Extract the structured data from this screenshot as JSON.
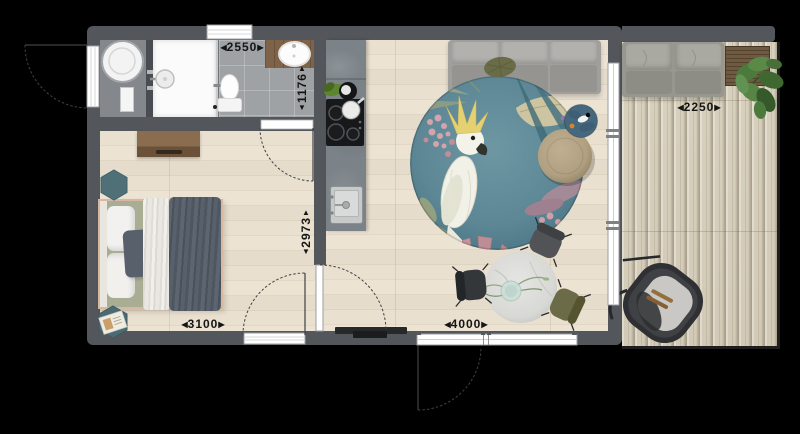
{
  "title": "tiny-house-floor-plan",
  "dimensions": {
    "arrow_left": "◀",
    "arrow_right": "▶",
    "arrow_up": "▲",
    "arrow_down": "▼",
    "bathroom_width": "2550",
    "bathroom_depth": "1176",
    "bedroom_depth": "2973",
    "bedroom_width": "3100",
    "living_width": "4000",
    "terrace_width": "2250"
  },
  "rooms": [
    {
      "id": "bathroom",
      "furniture": [
        "washing-machine",
        "shower",
        "toilet",
        "washbasin-counter"
      ]
    },
    {
      "id": "bedroom",
      "furniture": [
        "double-bed",
        "dresser",
        "hexagonal-side-table",
        "hexagonal-side-table-with-books"
      ]
    },
    {
      "id": "kitchen",
      "furniture": [
        "counter",
        "cooktop",
        "kitchen-sink",
        "pot",
        "greens"
      ]
    },
    {
      "id": "living-room",
      "furniture": [
        "three-seat-sofa",
        "round-cockatoo-rug",
        "pouf",
        "round-side-table",
        "dining-table",
        "dining-chairs",
        "tv"
      ]
    },
    {
      "id": "terrace",
      "furniture": [
        "outdoor-sofa",
        "slat-table",
        "plant",
        "hanging-chair"
      ]
    }
  ],
  "palette": {
    "background": "#000000",
    "wall": "#53565a",
    "wood_floor": "#e7decd",
    "deck": "#d5cdba",
    "tile_floor": "#9fa2a5",
    "bath_counter_wood": "#7e6349",
    "kitchen_concrete": "#7c8388",
    "rug_teal": "#5d8795",
    "sofa_gray": "#a3a2a0",
    "bed_sage": "#a9ad94",
    "duvet_dark": "#545c66",
    "hexagon_teal": "#507078",
    "pouf_tan": "#b5a486",
    "chair_olive": "#6c6b48",
    "dining_marble": "#dcdcda",
    "bed_frame_copper": "#d7b8a2"
  }
}
